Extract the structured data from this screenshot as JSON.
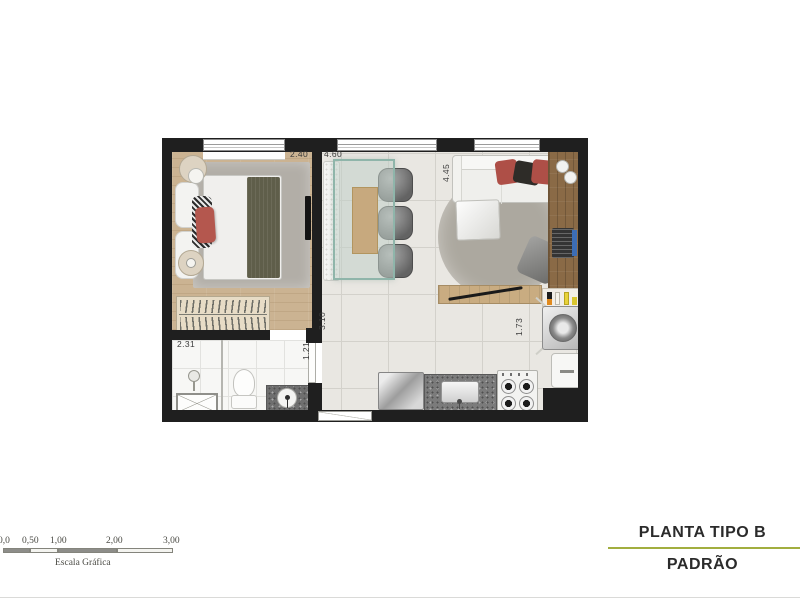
{
  "footer": {
    "title": "PLANTA TIPO B",
    "subtitle": "PADRÃO",
    "accent_color": "#a2ae3f"
  },
  "scale_bar": {
    "tick_labels": [
      "0,0",
      "0,50",
      "1,00",
      "2,00",
      "3,00"
    ],
    "caption": "Escala Gráfica"
  },
  "dimensions": {
    "bedroom_width": "2.40",
    "living_width": "4.60",
    "living_depth": "4.45",
    "bedroom_depth": "3.10",
    "hall_width": "1.21",
    "bathroom_width": "2.31",
    "kitchen_depth": "1.73"
  },
  "colors": {
    "wall": "#1f1f1f",
    "wood_floor": "#cbb392",
    "tile_floor": "#e9e7e2",
    "desk_wood": "#8a6a46",
    "accent_red": "#ae4f47",
    "accent_line": "#a2ae3f"
  }
}
